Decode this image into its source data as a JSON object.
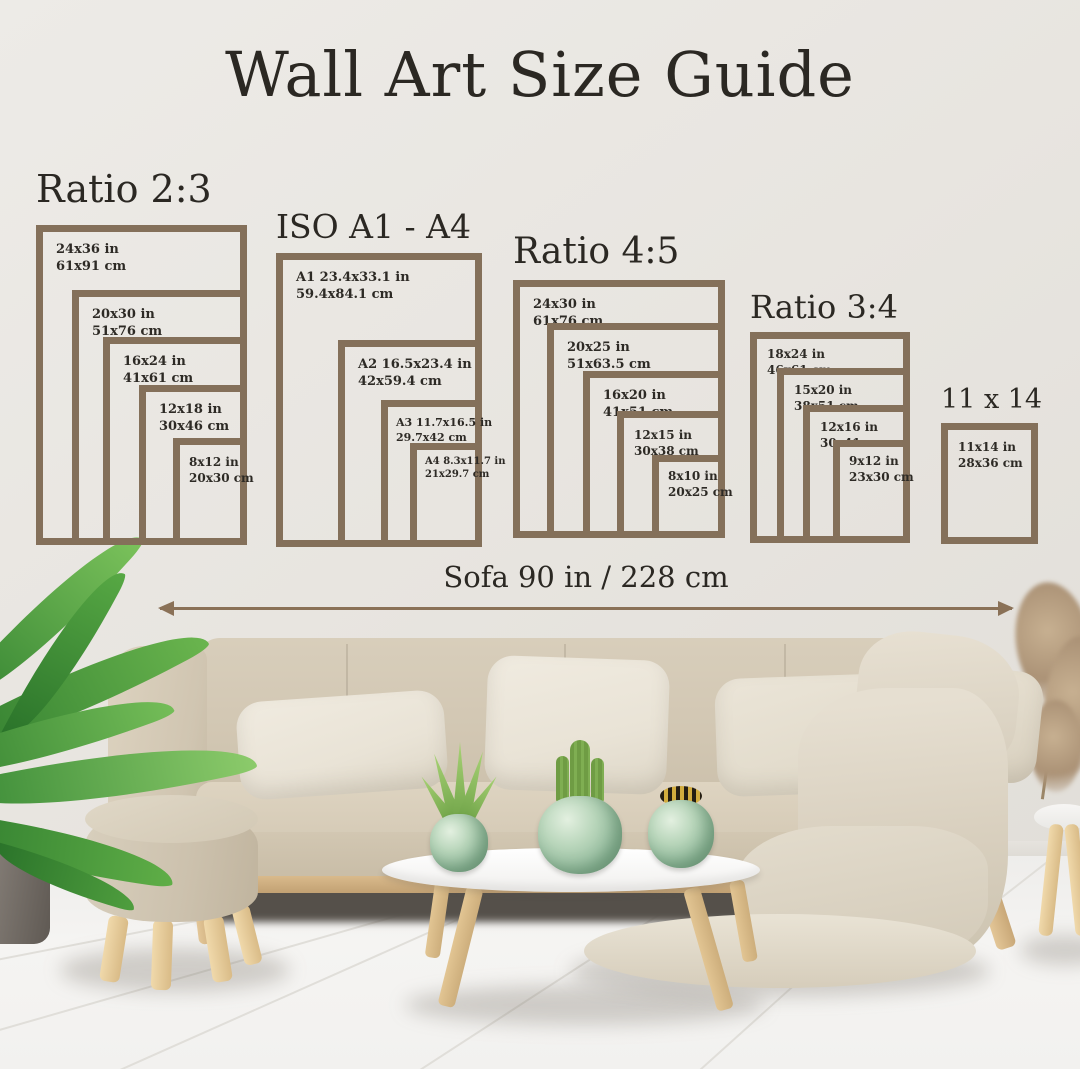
{
  "title": "Wall Art Size Guide",
  "groups": [
    {
      "heading": "Ratio 2:3",
      "frames": [
        {
          "size_in": "24x36 in",
          "size_cm": "61x91 cm"
        },
        {
          "size_in": "20x30 in",
          "size_cm": "51x76 cm"
        },
        {
          "size_in": "16x24 in",
          "size_cm": "41x61 cm"
        },
        {
          "size_in": "12x18 in",
          "size_cm": "30x46 cm"
        },
        {
          "size_in": "8x12 in",
          "size_cm": "20x30 cm"
        }
      ]
    },
    {
      "heading": "ISO A1 - A4",
      "frames": [
        {
          "size_in": "A1 23.4x33.1 in",
          "size_cm": "59.4x84.1 cm"
        },
        {
          "size_in": "A2 16.5x23.4 in",
          "size_cm": "42x59.4 cm"
        },
        {
          "size_in": "A3 11.7x16.5 in",
          "size_cm": "29.7x42 cm"
        },
        {
          "size_in": "A4 8.3x11.7 in",
          "size_cm": "21x29.7 cm"
        }
      ]
    },
    {
      "heading": "Ratio 4:5",
      "frames": [
        {
          "size_in": "24x30 in",
          "size_cm": "61x76 cm"
        },
        {
          "size_in": "20x25 in",
          "size_cm": "51x63.5 cm"
        },
        {
          "size_in": "16x20 in",
          "size_cm": "41x51 cm"
        },
        {
          "size_in": "12x15 in",
          "size_cm": "30x38 cm"
        },
        {
          "size_in": "8x10 in",
          "size_cm": "20x25 cm"
        }
      ]
    },
    {
      "heading": "Ratio 3:4",
      "frames": [
        {
          "size_in": "18x24 in",
          "size_cm": "46x61 cm"
        },
        {
          "size_in": "15x20 in",
          "size_cm": "38x51 cm"
        },
        {
          "size_in": "12x16 in",
          "size_cm": "30x41 cm"
        },
        {
          "size_in": "9x12 in",
          "size_cm": "23x30 cm"
        }
      ]
    },
    {
      "heading": "11 x 14",
      "frames": [
        {
          "size_in": "11x14 in",
          "size_cm": "28x36 cm"
        }
      ]
    }
  ],
  "measure": {
    "label": "Sofa 90 in / 228 cm"
  },
  "colors": {
    "frame_border": "#84705a",
    "heading_text": "#2b2823",
    "label_text": "#2d2a25",
    "arrow": "#8a7157",
    "wall": "#e9e6e1",
    "sofa": "#d3c8b3",
    "plant_green": "#6fae4f"
  }
}
